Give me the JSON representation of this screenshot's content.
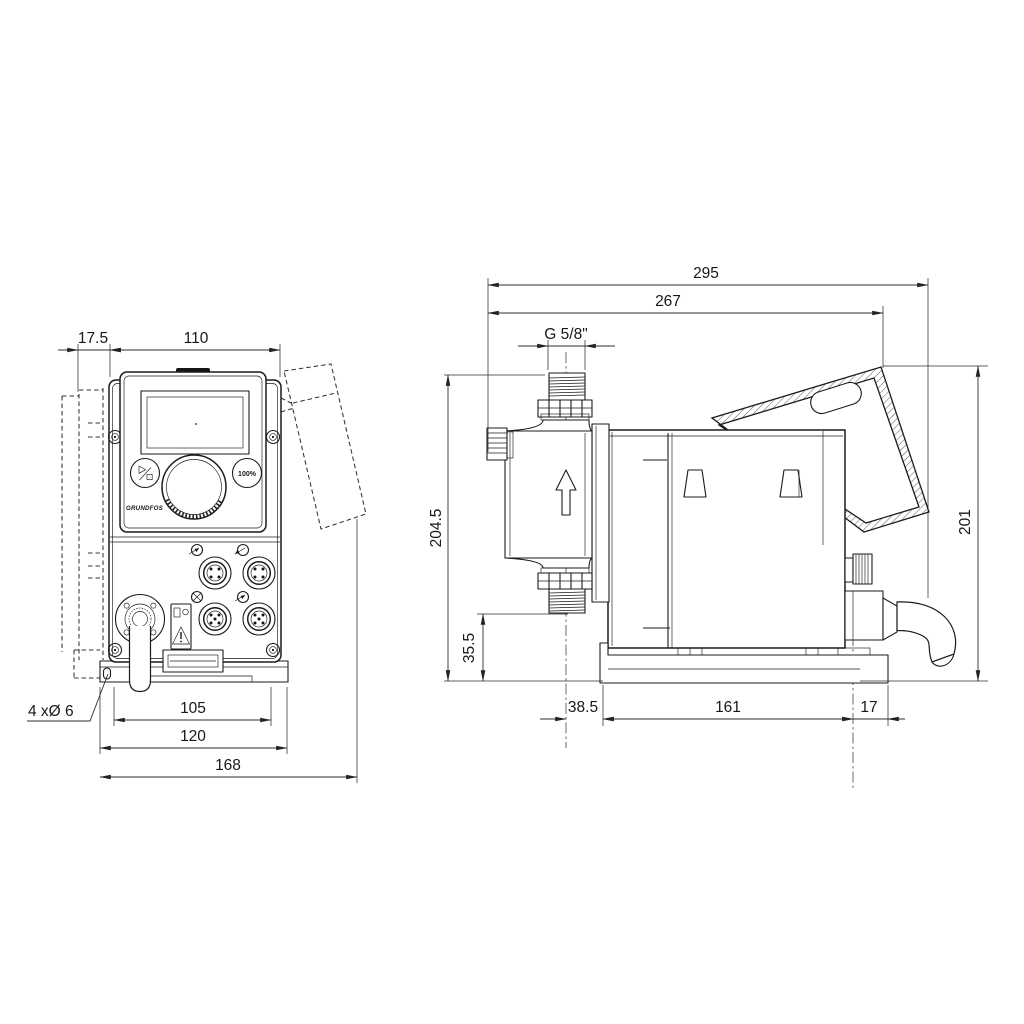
{
  "drawing": {
    "front_view": {
      "dim_flange_offset": "17.5",
      "dim_control_width": "110",
      "dim_hole_pitch": "105",
      "dim_plate_width": "120",
      "dim_total_width": "168",
      "mounting_holes_label": "4 xØ 6",
      "brand": "GRUNDFOS",
      "capacity_button_label": "100%"
    },
    "side_view": {
      "dim_total_length": "295",
      "dim_body_length": "267",
      "connection_thread": "G 5/8\"",
      "dim_total_height": "204.5",
      "dim_valve_height": "35.5",
      "dim_center_offset": "38.5",
      "dim_base_length": "161",
      "dim_base_overhang": "17",
      "dim_right_height": "201"
    },
    "colors": {
      "line": "#1b1b1b",
      "dimension": "#2c2c2c",
      "background": "#ffffff"
    }
  }
}
